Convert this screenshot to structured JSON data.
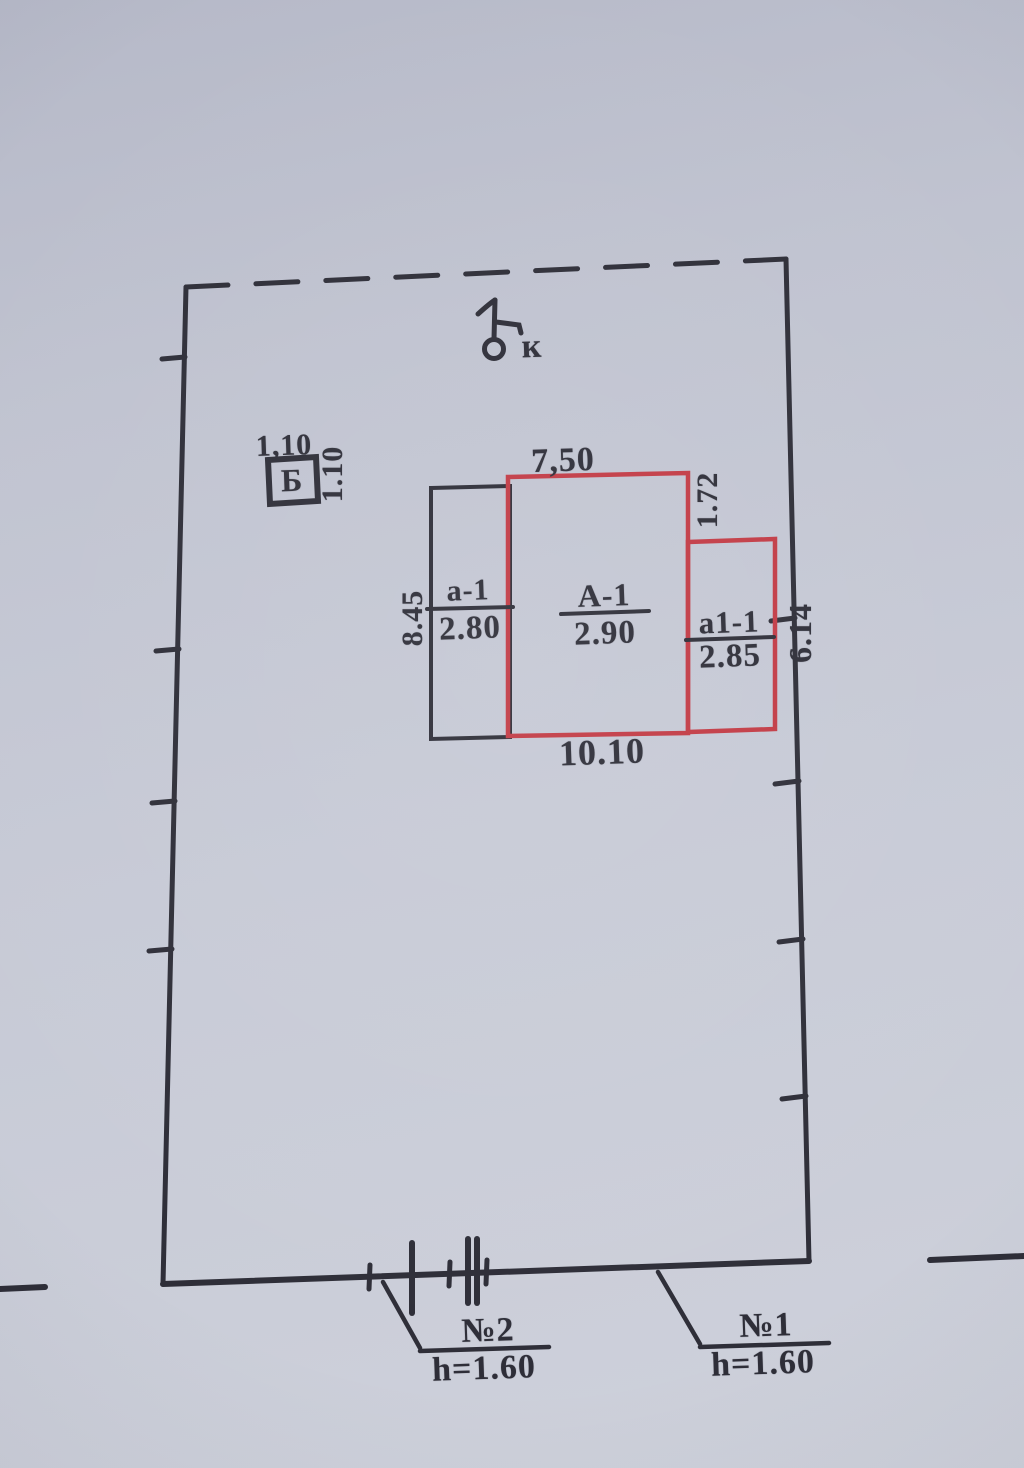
{
  "plan": {
    "well_symbol": "к",
    "shed": {
      "label": "Б",
      "dim_top": "1,10",
      "dim_side": "1.10"
    },
    "buildings": {
      "dim_top": "7,50",
      "dim_right_offset": "1.72",
      "dim_left": "8.45",
      "dim_right": "6.14",
      "dim_bottom": "10.10",
      "parts": [
        {
          "label": "а-1",
          "value": "2.80"
        },
        {
          "label": "А-1",
          "value": "2.90"
        },
        {
          "label": "а1-1",
          "value": "2.85"
        }
      ]
    },
    "gates": [
      {
        "label": "№2",
        "height": "h=1.60"
      },
      {
        "label": "№1",
        "height": "h=1.60"
      }
    ],
    "colors": {
      "ink": "#2e2e38",
      "red": "#c23b45",
      "paper": "#c5c8d4"
    }
  }
}
